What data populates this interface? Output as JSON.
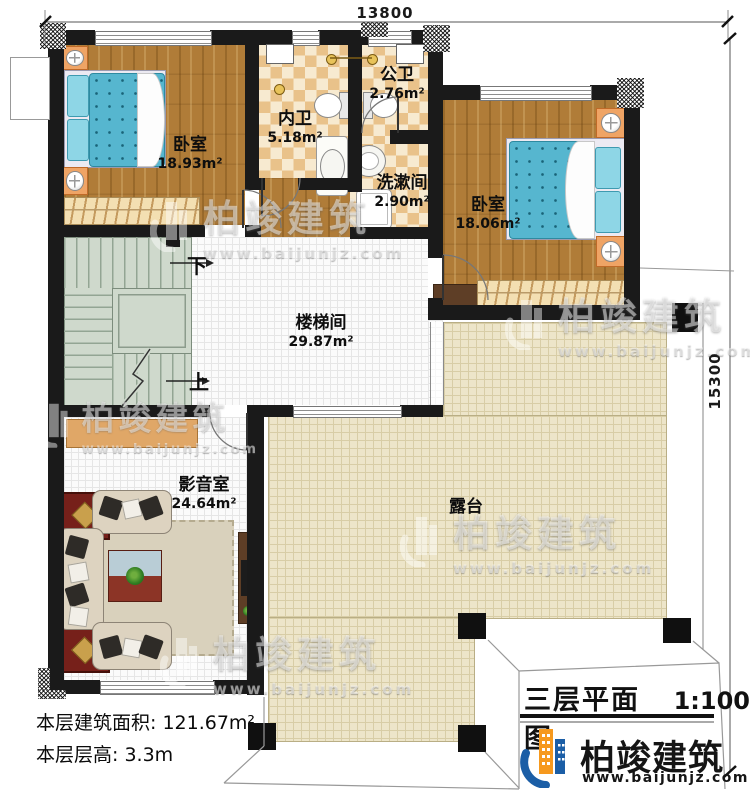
{
  "drawing": {
    "type": "floor-plan",
    "dimensions": {
      "width_mm": "13800",
      "height_mm": "15300"
    },
    "rooms": {
      "bedroom1": {
        "name": "卧室",
        "area": "18.93m²"
      },
      "bedroom2": {
        "name": "卧室",
        "area": "18.06m²"
      },
      "inner_bathroom": {
        "name": "内卫",
        "area": "5.18m²"
      },
      "public_bathroom": {
        "name": "公卫",
        "area": "2.76m²"
      },
      "washroom": {
        "name": "洗漱间",
        "area": "2.90m²"
      },
      "stairwell": {
        "name": "楼梯间",
        "area": "29.87m²"
      },
      "media_room": {
        "name": "影音室",
        "area": "24.64m²"
      },
      "terrace": {
        "name": "露台"
      }
    },
    "stairs": {
      "down_label": "下",
      "up_label": "上"
    },
    "title_block": {
      "title": "三层平面图",
      "scale": "1:100"
    },
    "footer": {
      "floor_area": "本层建筑面积: 121.67m²",
      "floor_height": "本层层高: 3.3m"
    },
    "brand": {
      "name": "柏竣建筑",
      "website": "www.baijunjz.com"
    },
    "colors": {
      "wall": "#1a1a1a",
      "logo_blue": "#1b5ea6",
      "logo_orange": "#f6991e"
    }
  }
}
